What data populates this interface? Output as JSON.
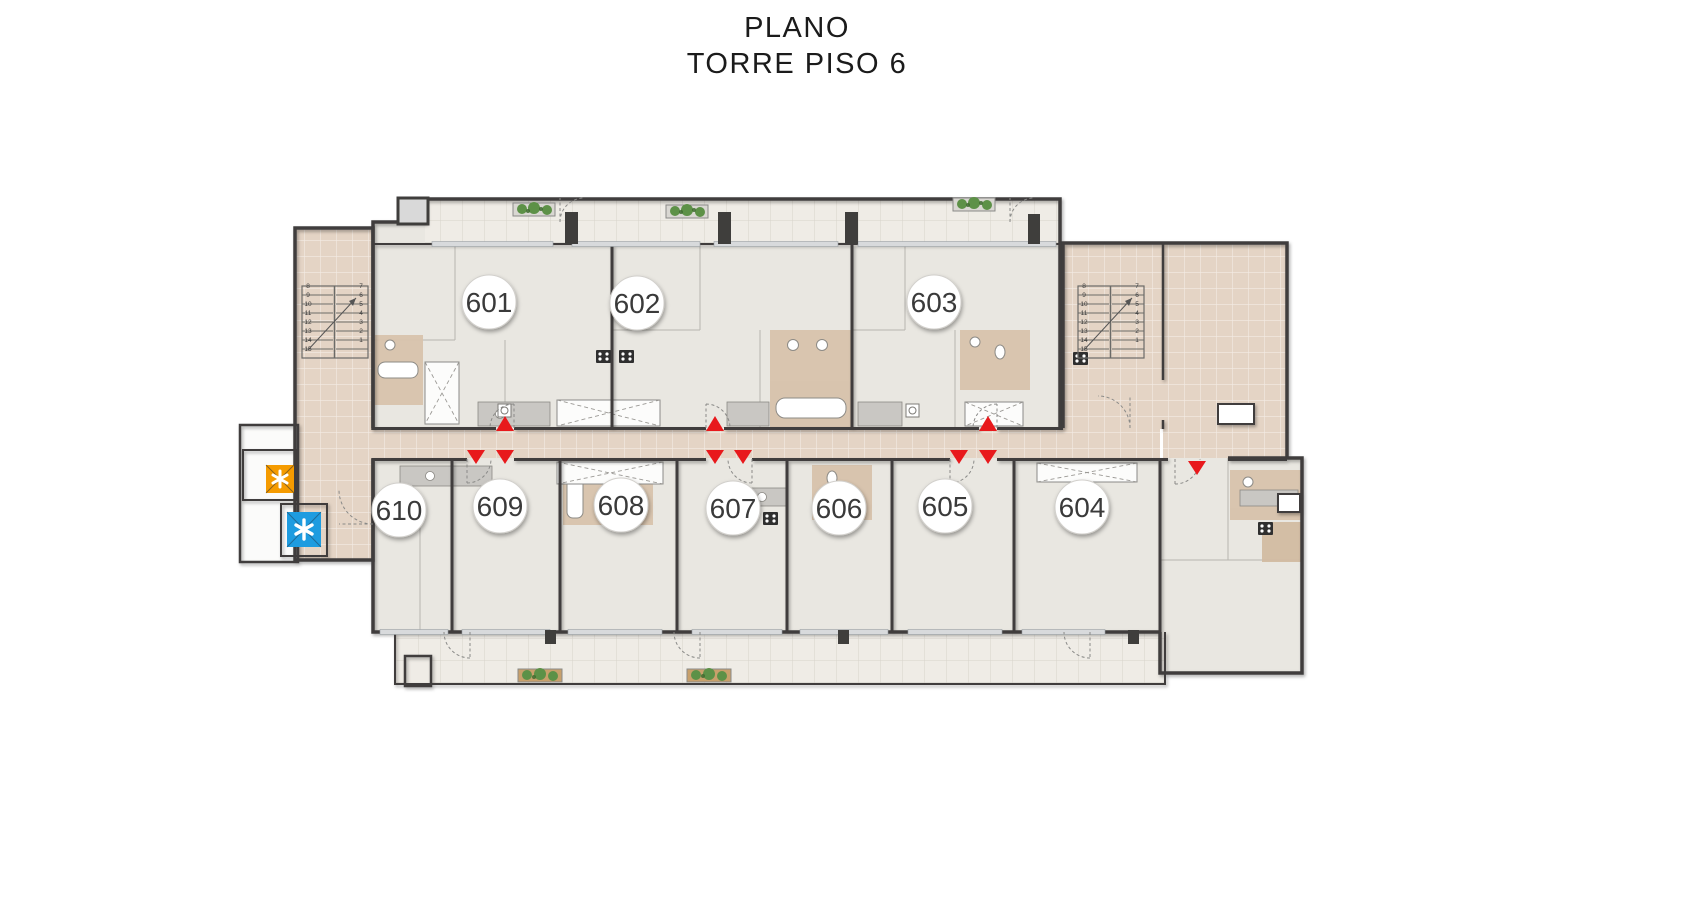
{
  "title": {
    "line1": "PLANO",
    "line2": "TORRE PISO 6"
  },
  "units": [
    {
      "number": "601"
    },
    {
      "number": "602"
    },
    {
      "number": "603"
    },
    {
      "number": "604"
    },
    {
      "number": "605"
    },
    {
      "number": "606"
    },
    {
      "number": "607"
    },
    {
      "number": "608"
    },
    {
      "number": "609"
    },
    {
      "number": "610"
    }
  ],
  "stairs": {
    "flight_up_numbers": "8\n9\n10\n11\n12\n13\n14\n15",
    "flight_down_numbers": "7\n6\n5\n4\n3\n2\n1"
  },
  "colors": {
    "entry_marker": "#e8191c",
    "elevator_a": "#f59b00",
    "elevator_b": "#1e9ce0",
    "plants": "#5d9147"
  }
}
